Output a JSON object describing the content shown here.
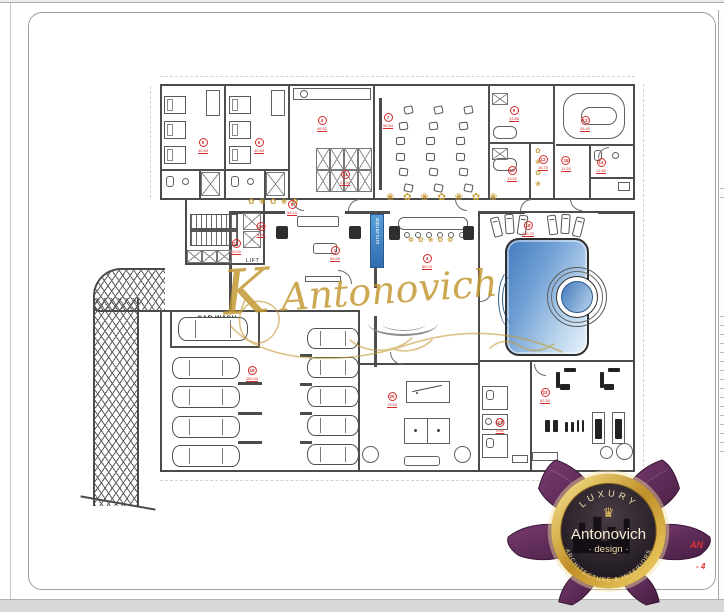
{
  "colors": {
    "wall": "#4b4b4b",
    "accent_red": "#d42a2a",
    "gold": "#c59a33",
    "pool_dark": "#447bbd",
    "pool_light": "#e8f3fb",
    "aquarium_blue": "#3f86c9",
    "logo_purple": "#5f2a5a",
    "logo_gold": "#e8c34a"
  },
  "labels": {
    "car_wash": "CAR WASH",
    "lift": "LIFT",
    "aquarium": "aquarium"
  },
  "watermark": {
    "text": "K Antonovich"
  },
  "logo": {
    "top_arc": "LUXURY",
    "crown": "♛",
    "name": "Antonovich",
    "subtitle": "· design ·",
    "bottom_arc": "ARCHITECTURE & INTERIORS"
  },
  "fragments": {
    "line1": "AN",
    "line2": "- 4"
  },
  "ornaments": {
    "corridor_left": "✿ ❀ ✿ ❀ ✿",
    "corridor_right": "❀ ✿ ❀ ✿ ❀ ✿ ❀",
    "vestibule": "✿ ❀ ✿ ❀",
    "bar": "❁ ✿ ❀ ✿ ❁"
  },
  "plan": {
    "markers": [
      {
        "n": "5",
        "area": "40.84",
        "x": 203,
        "y": 138
      },
      {
        "n": "6",
        "area": "40.84",
        "x": 259,
        "y": 138
      },
      {
        "n": "4",
        "area": "46.62",
        "x": 322,
        "y": 116
      },
      {
        "n": "11",
        "area": "21.40",
        "x": 345,
        "y": 170
      },
      {
        "n": "7",
        "area": "58.64",
        "x": 388,
        "y": 113
      },
      {
        "n": "9",
        "area": "13.86",
        "x": 514,
        "y": 106
      },
      {
        "n": "10",
        "area": "13.52",
        "x": 512,
        "y": 166
      },
      {
        "n": "12",
        "area": "16.70",
        "x": 543,
        "y": 155
      },
      {
        "n": "13",
        "area": "35.40",
        "x": 585,
        "y": 116
      },
      {
        "n": "15",
        "area": "11.20",
        "x": 566,
        "y": 156
      },
      {
        "n": "14",
        "area": "12.60",
        "x": 601,
        "y": 158
      },
      {
        "n": "8",
        "area": "58.10",
        "x": 292,
        "y": 200
      },
      {
        "n": "16",
        "area": "4.30",
        "x": 261,
        "y": 222
      },
      {
        "n": "17",
        "area": "13.00",
        "x": 236,
        "y": 239
      },
      {
        "n": "1",
        "area": "95.00",
        "x": 335,
        "y": 246
      },
      {
        "n": "3",
        "area": "88.70",
        "x": 427,
        "y": 254
      },
      {
        "n": "18",
        "area": "166.70",
        "x": 528,
        "y": 221
      },
      {
        "n": "19",
        "area": "150.00",
        "x": 252,
        "y": 366
      },
      {
        "n": "20",
        "area": "76.50",
        "x": 392,
        "y": 392
      },
      {
        "n": "21",
        "area": "9.80",
        "x": 500,
        "y": 418
      },
      {
        "n": "22",
        "area": "62.30",
        "x": 545,
        "y": 388
      }
    ],
    "cars": [
      {
        "x": 178,
        "y": 317,
        "w": 70,
        "h": 24
      },
      {
        "x": 172,
        "y": 357,
        "w": 68,
        "h": 22
      },
      {
        "x": 172,
        "y": 386,
        "w": 68,
        "h": 22
      },
      {
        "x": 172,
        "y": 416,
        "w": 68,
        "h": 22
      },
      {
        "x": 172,
        "y": 445,
        "w": 68,
        "h": 22
      },
      {
        "x": 307,
        "y": 328,
        "w": 52,
        "h": 21
      },
      {
        "x": 307,
        "y": 357,
        "w": 52,
        "h": 21
      },
      {
        "x": 307,
        "y": 386,
        "w": 52,
        "h": 21
      },
      {
        "x": 307,
        "y": 415,
        "w": 52,
        "h": 21
      },
      {
        "x": 307,
        "y": 444,
        "w": 52,
        "h": 21
      }
    ],
    "beds": [
      {
        "x": 164,
        "y": 96
      },
      {
        "x": 164,
        "y": 121
      },
      {
        "x": 164,
        "y": 146
      },
      {
        "x": 229,
        "y": 96
      },
      {
        "x": 229,
        "y": 121
      },
      {
        "x": 229,
        "y": 146
      }
    ],
    "loungers": [
      {
        "x": 492,
        "y": 217,
        "r": -14
      },
      {
        "x": 505,
        "y": 214,
        "r": -4
      },
      {
        "x": 518,
        "y": 215,
        "r": 8
      },
      {
        "x": 548,
        "y": 215,
        "r": -8
      },
      {
        "x": 561,
        "y": 214,
        "r": 4
      },
      {
        "x": 574,
        "y": 217,
        "r": 14
      }
    ],
    "cinema_rows": [
      {
        "cx": 404
      },
      {
        "cx": 434
      },
      {
        "cx": 464
      }
    ],
    "cinema": {
      "y0": 106,
      "y1": 184,
      "seats": 6,
      "bulge": 8
    },
    "xboxes": [
      {
        "x": 316,
        "y": 148,
        "w": 14,
        "h": 22
      },
      {
        "x": 330,
        "y": 148,
        "w": 14,
        "h": 22
      },
      {
        "x": 344,
        "y": 148,
        "w": 14,
        "h": 22
      },
      {
        "x": 358,
        "y": 148,
        "w": 14,
        "h": 22
      },
      {
        "x": 316,
        "y": 170,
        "w": 14,
        "h": 22
      },
      {
        "x": 330,
        "y": 170,
        "w": 14,
        "h": 22
      },
      {
        "x": 344,
        "y": 170,
        "w": 14,
        "h": 22
      },
      {
        "x": 358,
        "y": 170,
        "w": 14,
        "h": 22
      },
      {
        "x": 201,
        "y": 172,
        "w": 19,
        "h": 24
      },
      {
        "x": 266,
        "y": 172,
        "w": 19,
        "h": 24
      },
      {
        "x": 243,
        "y": 213,
        "w": 18,
        "h": 17
      },
      {
        "x": 243,
        "y": 231,
        "w": 18,
        "h": 17
      },
      {
        "x": 187,
        "y": 250,
        "w": 15,
        "h": 13
      },
      {
        "x": 202,
        "y": 250,
        "w": 15,
        "h": 13
      },
      {
        "x": 217,
        "y": 250,
        "w": 15,
        "h": 13
      },
      {
        "x": 492,
        "y": 93,
        "w": 16,
        "h": 12
      },
      {
        "x": 492,
        "y": 148,
        "w": 16,
        "h": 12
      }
    ],
    "doors": [
      {
        "x": 292,
        "y": 199,
        "s": 12,
        "r": 0
      },
      {
        "x": 348,
        "y": 199,
        "s": 12,
        "r": 90
      },
      {
        "x": 455,
        "y": 199,
        "s": 12,
        "r": 0
      },
      {
        "x": 520,
        "y": 199,
        "s": 12,
        "r": 90
      },
      {
        "x": 570,
        "y": 199,
        "s": 12,
        "r": 0
      },
      {
        "x": 338,
        "y": 270,
        "s": 14,
        "r": 180
      },
      {
        "x": 390,
        "y": 352,
        "s": 13,
        "r": 0
      },
      {
        "x": 480,
        "y": 290,
        "s": 12,
        "r": 270
      },
      {
        "x": 534,
        "y": 364,
        "s": 12,
        "r": 0
      },
      {
        "x": 598,
        "y": 147,
        "s": 11,
        "r": 90
      }
    ]
  }
}
